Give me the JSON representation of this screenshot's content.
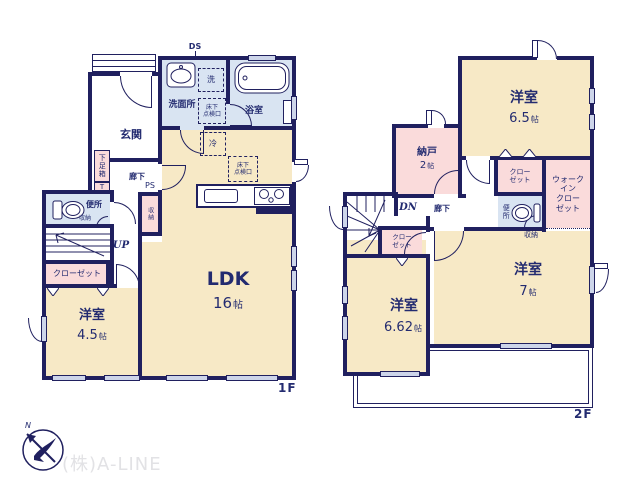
{
  "colors": {
    "wall": "#20205f",
    "cream": "#f7e9c6",
    "pink": "#fadbdb",
    "blue": "#d9e4f2",
    "ink": "#232b70",
    "window": "#cdd5ea",
    "watermark": "#e2e2e5"
  },
  "f1": {
    "floor_label": "1F",
    "ds": "DS",
    "senmenjo": "洗面所",
    "sen": "洗",
    "yukashita": "床下\n点検口",
    "yokushitsu": "浴室",
    "genkan": "玄関",
    "getabako": "下足箱",
    "t_box": "T",
    "rouka": "廊下",
    "ps": "PS",
    "shuno_shaft": "収納",
    "benjo": "便所",
    "shuno_wc": "収納",
    "up": "UP",
    "closet": "クローゼット",
    "yoshitsu": "洋室",
    "yoshitsu_num": "4.5",
    "ldk": "LDK",
    "ldk_num": "16",
    "rei": "冷"
  },
  "f2": {
    "floor_label": "2F",
    "yoshitsu_a": "洋室",
    "yoshitsu_a_num": "6.5",
    "nando": "納戸",
    "nando_num": "2",
    "closet_top": "クロー\nゼット",
    "wic": "ウォーク\nイン\nクロー\nゼット",
    "benjo": "便所",
    "shuno": "収納",
    "dn": "DN",
    "rouka": "廊下",
    "closet_small": "クロー\nゼット",
    "yoshitsu_b": "洋室",
    "yoshitsu_b_num": "6.62",
    "yoshitsu_c": "洋室",
    "yoshitsu_c_num": "7"
  },
  "units": {
    "jo": "帖"
  },
  "footer": {
    "company": "(株)A-LINE",
    "compass_n": "N"
  }
}
